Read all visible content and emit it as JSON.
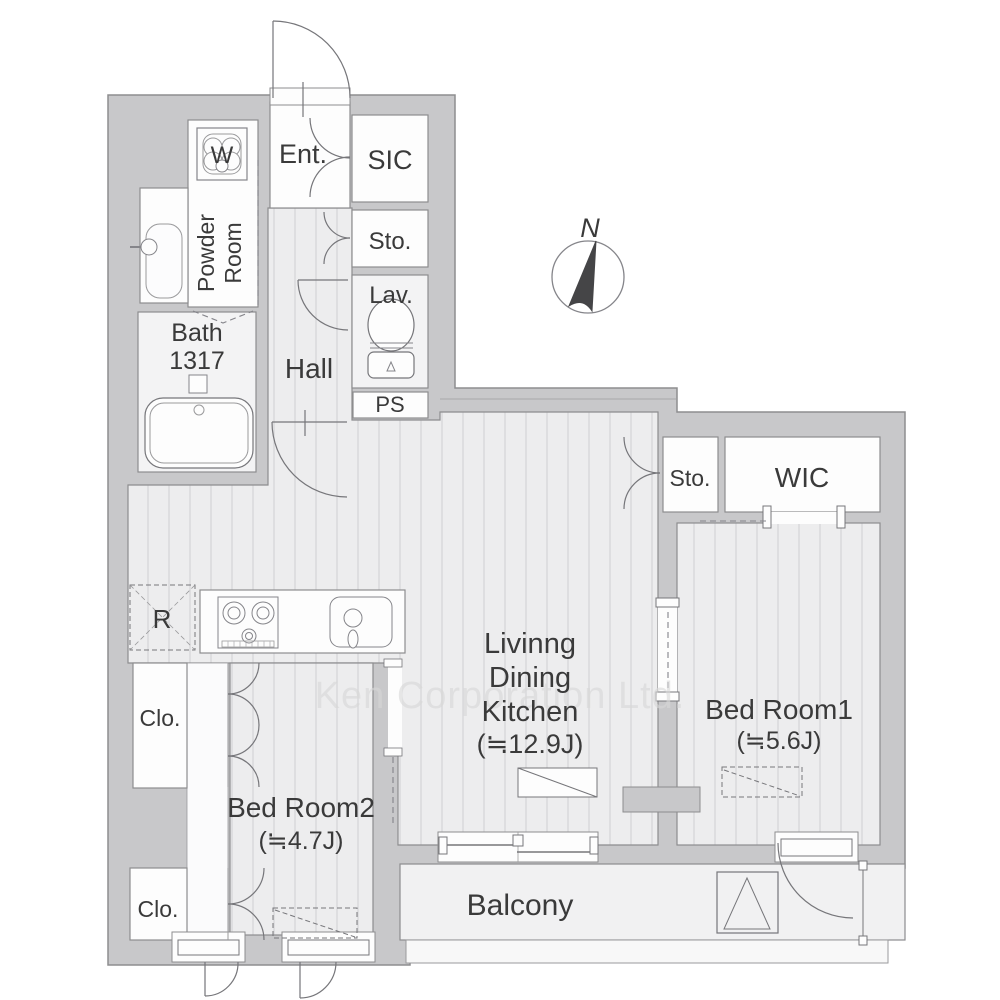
{
  "watermark": {
    "text": "Ken Corporation Ltd."
  },
  "compass": {
    "label": "N"
  },
  "rooms": {
    "entrance": {
      "label": "Ent."
    },
    "shoe_in_closet": {
      "label": "SIC"
    },
    "storage_top": {
      "label": "Sto."
    },
    "lavatory": {
      "label": "Lav."
    },
    "pipe_space": {
      "label": "PS"
    },
    "powder_room": {
      "label_line1": "Powder",
      "label_line2": "Room"
    },
    "bath": {
      "label": "Bath",
      "size_code": "1317"
    },
    "hall": {
      "label": "Hall"
    },
    "ldk": {
      "label_line1": "Livinng",
      "label_line2": "Dining",
      "label_line3": "Kitchen",
      "area": "(≒12.9J)"
    },
    "storage_right": {
      "label": "Sto."
    },
    "walk_in_closet": {
      "label": "WIC"
    },
    "bedroom1": {
      "label": "Bed Room1",
      "area": "(≒5.6J)"
    },
    "bedroom2": {
      "label": "Bed Room2",
      "area": "(≒4.7J)"
    },
    "closet_upper": {
      "label": "Clo."
    },
    "closet_lower": {
      "label": "Clo."
    },
    "balcony": {
      "label": "Balcony"
    }
  },
  "fixtures": {
    "washing_machine": {
      "label": "W"
    },
    "refrigerator": {
      "label": "R"
    }
  },
  "colors": {
    "wall": "#c8c8ca",
    "floor_base": "#ededee",
    "floor_stripe": "#d8d8da",
    "room_white": "#fdfdfd",
    "outline": "#8d8d8f",
    "text": "#3a3a3a",
    "watermark": "#d8d8d8"
  }
}
